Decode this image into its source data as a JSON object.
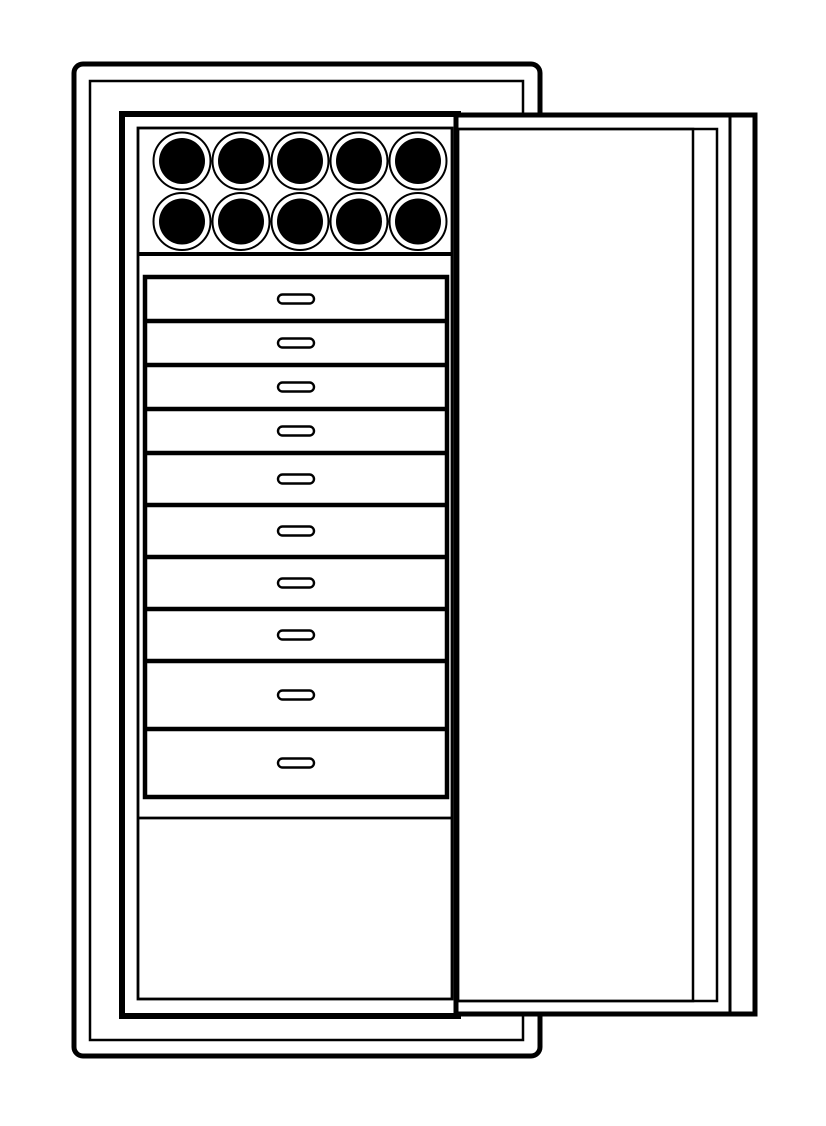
{
  "figure": {
    "background_color": "#ffffff",
    "line_color": "#000000",
    "canvas": {
      "width": 826,
      "height": 1126
    },
    "outer_case": {
      "x": 74,
      "y": 64,
      "w": 466,
      "h": 992,
      "stroke": 5,
      "corner_radius": 9
    },
    "inner_case": {
      "x": 90,
      "y": 81,
      "w": 433,
      "h": 959,
      "stroke": 2.5
    },
    "cabinet_body": {
      "x": 122,
      "y": 114,
      "w": 336,
      "h": 902,
      "stroke": 6
    },
    "cabinet_lining": {
      "x": 138,
      "y": 128,
      "w": 314,
      "h": 871,
      "stroke": 2.8
    },
    "slot_grid": {
      "rows": 2,
      "cols": 5,
      "row_centers_y": [
        161,
        221.5
      ],
      "col_centers_x": [
        182,
        241,
        300,
        359,
        418
      ],
      "ring_radius": 28.5,
      "ring_stroke": 2,
      "disc_radius": 23,
      "disc_fill": "#000000",
      "shelf_line_y": 254,
      "shelf_line_stroke": 4
    },
    "drawer_stack": {
      "box": {
        "x": 145,
        "y": 277,
        "w": 302,
        "h": 520,
        "stroke": 4.5
      },
      "count": 10,
      "boundaries_y": [
        277,
        321,
        365,
        409,
        453,
        505,
        557,
        609,
        661,
        729,
        797
      ],
      "divider_stroke": 4.5,
      "handle": {
        "center_x": 296,
        "w": 36,
        "h": 9,
        "rx": 4.5,
        "stroke": 2.4
      }
    },
    "bottom_compartment": {
      "divider_y": 818,
      "divider_stroke": 2.8,
      "x1": 138,
      "x2": 452
    },
    "door": {
      "x": 456,
      "y": 115,
      "w": 299,
      "h": 899,
      "stroke": 5,
      "face": {
        "x": 458,
        "y": 129,
        "w": 259,
        "h": 872,
        "stroke": 2.5
      },
      "panel": {
        "x": 458,
        "y": 129,
        "w": 235,
        "h": 872,
        "stroke": 2.5
      },
      "edge_line_x": 730,
      "edge_line_stroke": 3
    }
  }
}
